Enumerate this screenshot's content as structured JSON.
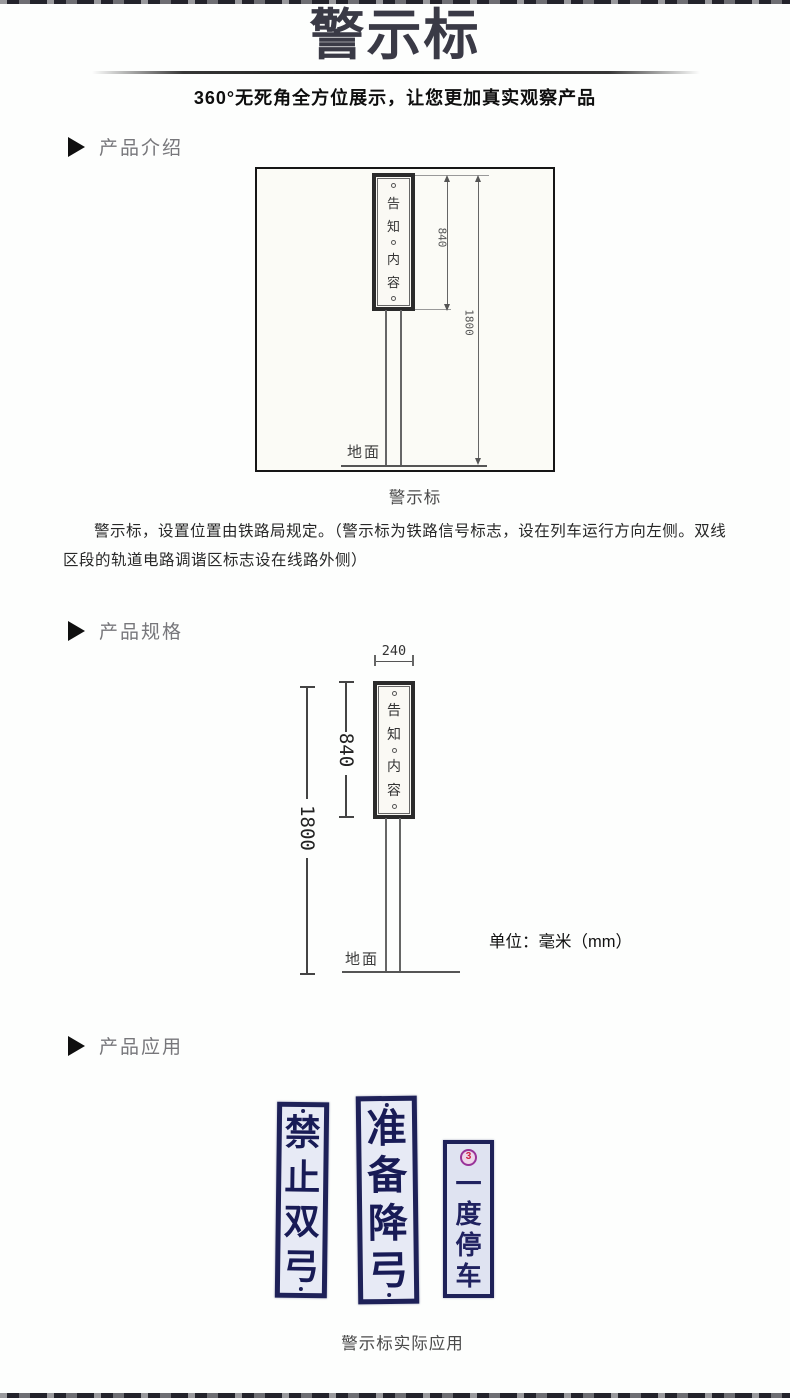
{
  "header": {
    "title": "警示标",
    "subtitle": "360°无死角全方位展示，让您更加真实观察产品"
  },
  "sections": {
    "intro": {
      "heading": "产品介绍",
      "diagram_caption": "警示标",
      "description": "警示标，设置位置由铁路局规定。（警示标为铁路信号标志，设在列车运行方向左侧。双线区段的轨道电路调谐区标志设在线路外侧）"
    },
    "spec": {
      "heading": "产品规格",
      "unit_note": "单位：毫米（mm）"
    },
    "app": {
      "heading": "产品应用",
      "caption": "警示标实际应用"
    }
  },
  "diagram_intro": {
    "sign_chars": [
      "告",
      "知",
      "内",
      "容"
    ],
    "dim_sign_height": "840",
    "dim_total_height": "1800",
    "ground_label": "地面"
  },
  "diagram_spec": {
    "dim_width": "240",
    "sign_chars": [
      "告",
      "知",
      "内",
      "容"
    ],
    "dim_sign_height": "840",
    "dim_total_height": "1800",
    "ground_label": "地面"
  },
  "app_signs": [
    {
      "name": "禁止双弓",
      "chars": [
        "禁",
        "止",
        "双",
        "弓"
      ]
    },
    {
      "name": "准备降弓",
      "chars": [
        "准",
        "备",
        "降",
        "弓"
      ]
    },
    {
      "name": "一度停车",
      "chars": [
        "一",
        "度",
        "停",
        "车"
      ],
      "badge": "3"
    }
  ],
  "colors": {
    "title_text": "#3a3a46",
    "heading_text": "#77777b",
    "sign_navy": "#1e2158",
    "sign_plate_bg": "#e7eaf5",
    "badge_ring": "#993399",
    "badge_glyph": "#cc2244"
  }
}
